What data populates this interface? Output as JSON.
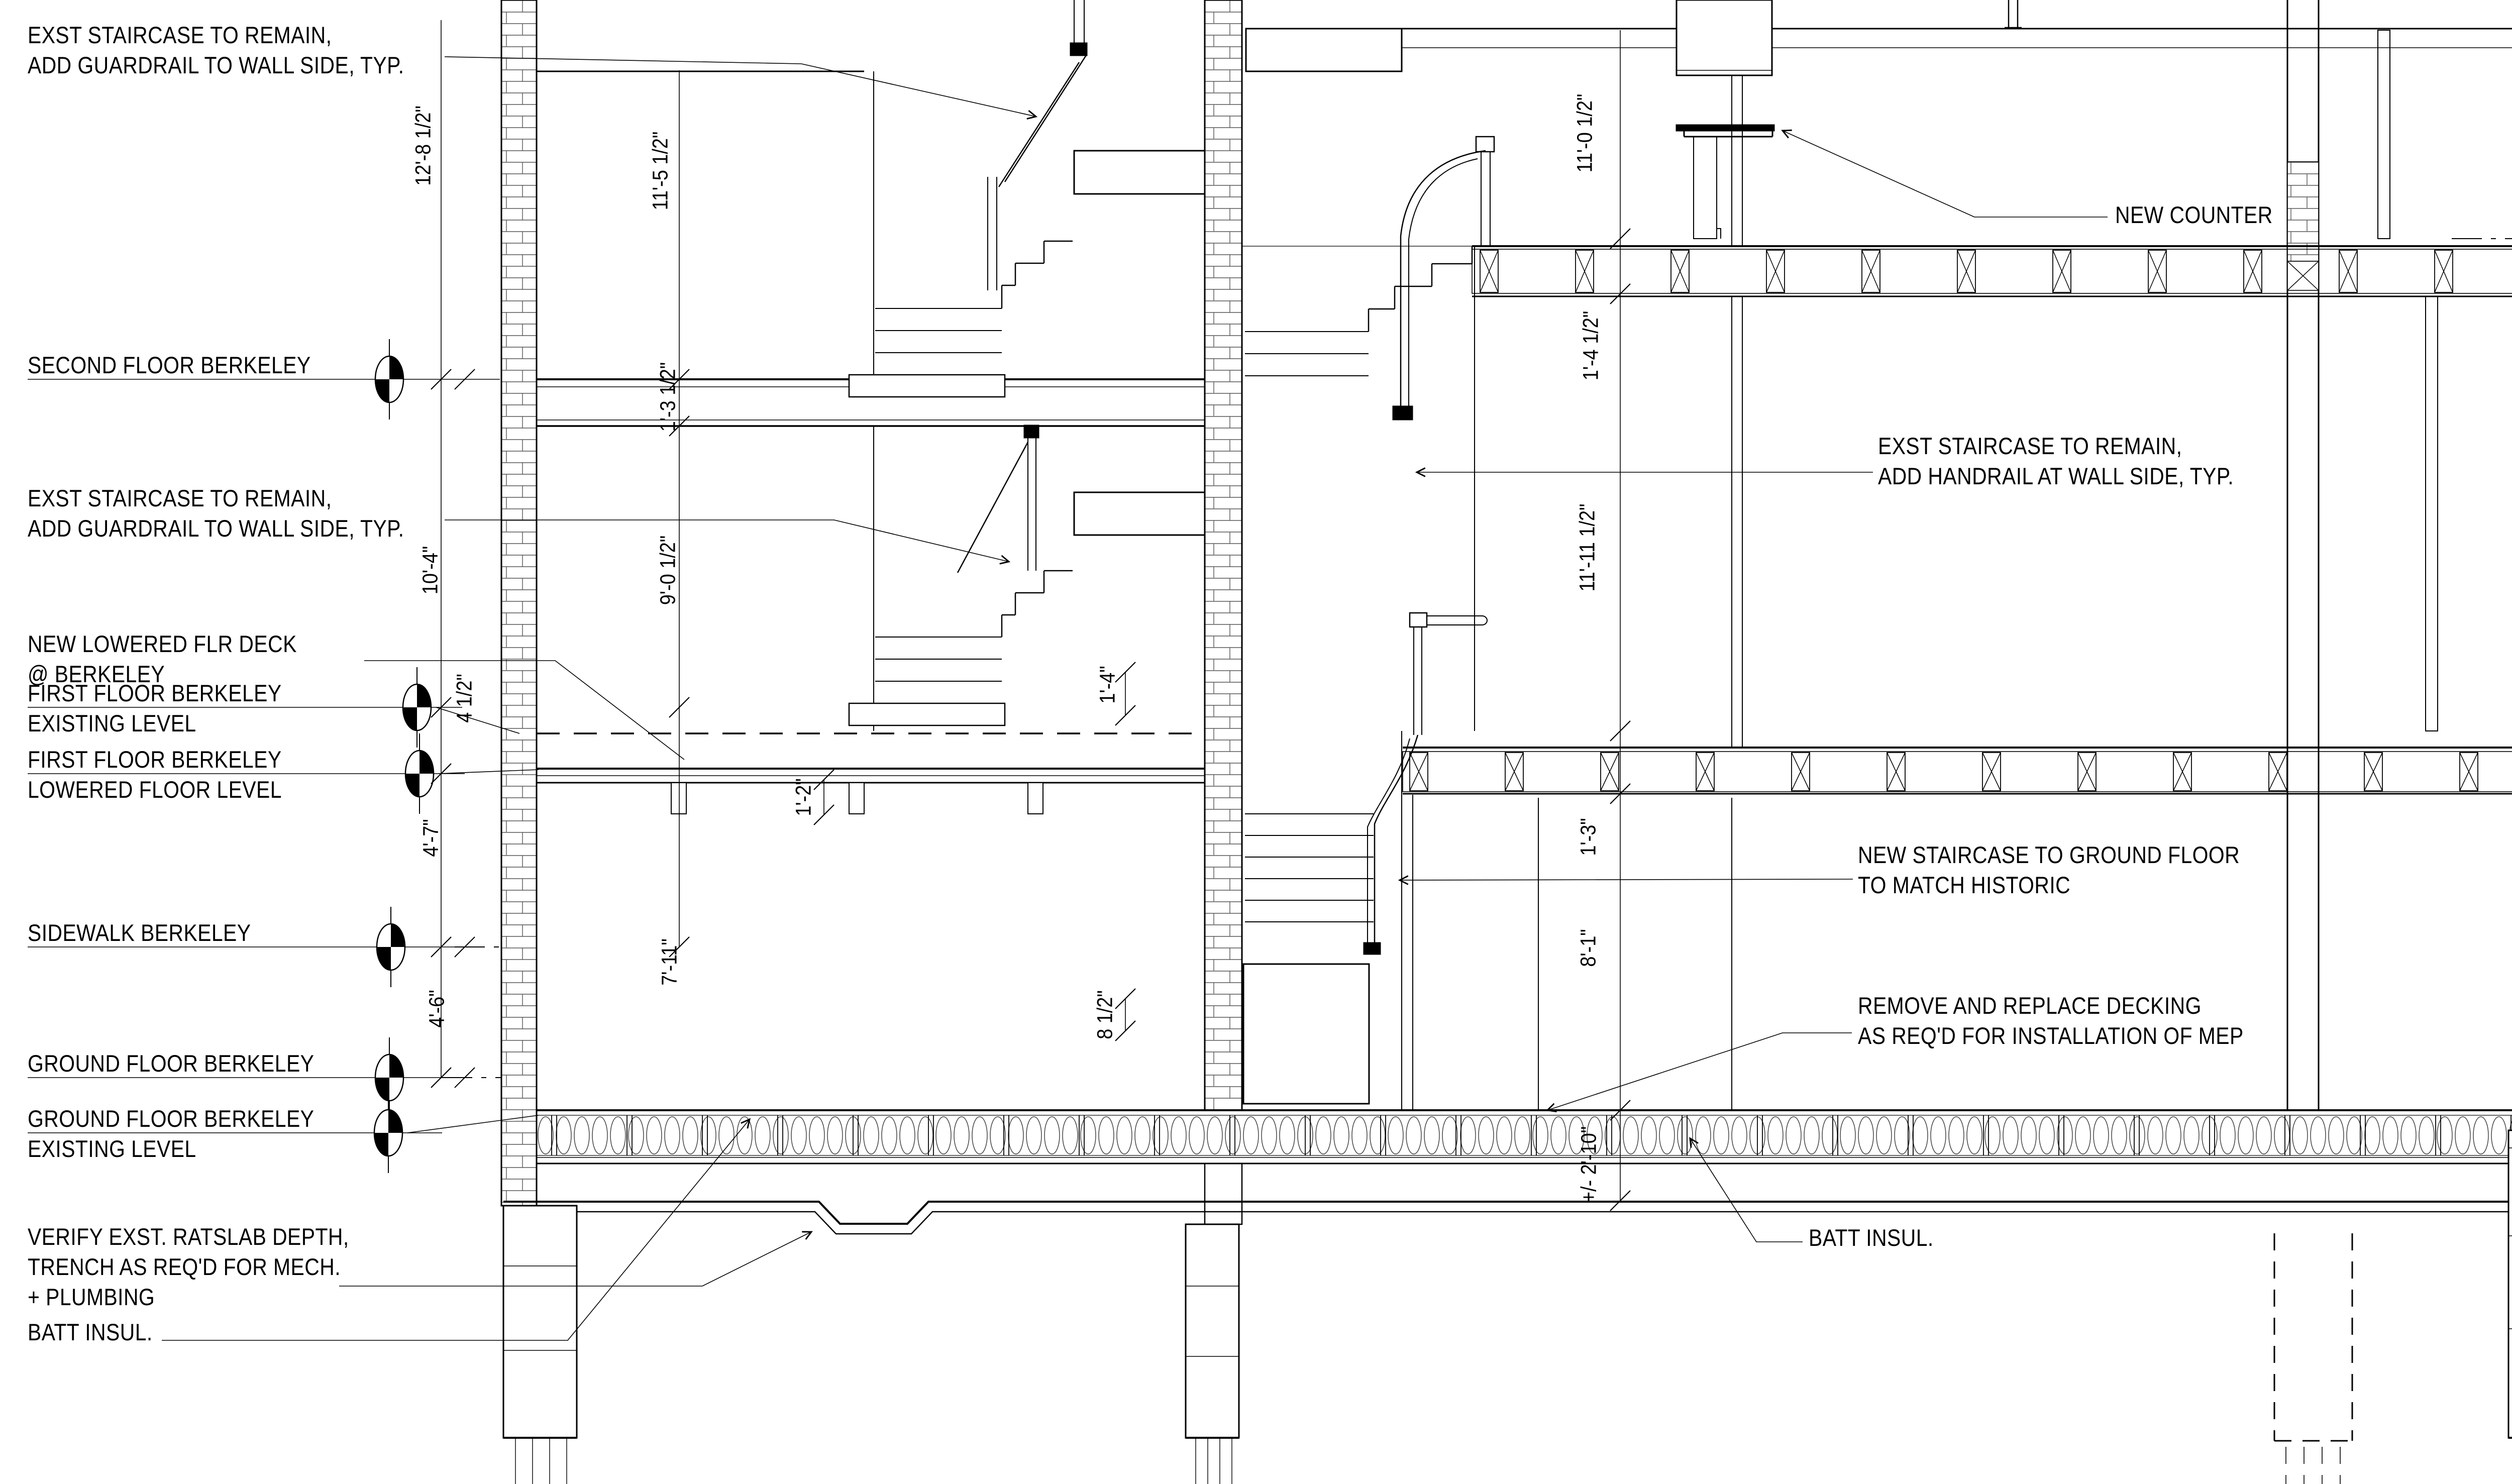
{
  "meta": {
    "drawing_type": "building section"
  },
  "colors": {
    "ink": "#000000",
    "paper": "#ffffff"
  },
  "callouts": {
    "exst_guardrail_upper": {
      "text": "EXST STAIRCASE TO REMAIN,\nADD GUARDRAIL TO WALL SIDE, TYP."
    },
    "exst_guardrail_lower": {
      "text": "EXST STAIRCASE TO REMAIN,\nADD GUARDRAIL TO WALL SIDE, TYP."
    },
    "new_lowered_deck": {
      "text": "NEW LOWERED FLR DECK\n@ BERKELEY"
    },
    "verify_ratslab": {
      "text": "VERIFY EXST. RATSLAB DEPTH,\nTRENCH AS REQ'D FOR MECH.\n+ PLUMBING"
    },
    "batt_insul_left": {
      "text": "BATT INSUL."
    },
    "new_counter": {
      "text": "NEW COUNTER"
    },
    "exst_handrail": {
      "text": "EXST STAIRCASE TO REMAIN,\nADD HANDRAIL AT WALL SIDE, TYP."
    },
    "new_staircase": {
      "text": "NEW STAIRCASE TO GROUND FLOOR\nTO MATCH HISTORIC"
    },
    "remove_decking": {
      "text": "REMOVE AND REPLACE DECKING\nAS REQ'D FOR INSTALLATION OF MEP"
    },
    "batt_insul_center": {
      "text": "BATT INSUL."
    },
    "exst_stair": {
      "text": "EXST. STAIR"
    },
    "frame_insulate": {
      "text": "FRAME, INSULATE +\nPLASTER WALLS +\nCLG."
    },
    "new_mtl_handrail": {
      "text": "NEW MTL\nHANDRAIL @\nEXST. STAIR"
    },
    "exst_conc_slab": {
      "text": "EXST CONC SLAB, PTD"
    }
  },
  "levels": {
    "second_floor_berkeley": {
      "label": "SECOND FLOOR BERKELEY"
    },
    "first_floor_berkeley_existing": {
      "label": "FIRST FLOOR BERKELEY\nEXISTING LEVEL"
    },
    "first_floor_berkeley_lowered": {
      "label": "FIRST FLOOR BERKELEY\nLOWERED FLOOR LEVEL"
    },
    "sidewalk_berkeley": {
      "label": "SIDEWALK BERKELEY"
    },
    "ground_floor_berkeley": {
      "label": "GROUND FLOOR BERKELEY"
    },
    "ground_floor_berkeley_existing": {
      "label": "GROUND FLOOR BERKELEY\nEXISTING LEVEL"
    },
    "second_floor_marlborough": {
      "label": "SECOND FLOOR MARLBOROUGH"
    },
    "first_floor_marlborough": {
      "label": "FIRST FLOOR MARLBOROUGH"
    },
    "sidewalk_marlborough": {
      "label": "SIDEWALK MARLBOROUGH"
    },
    "ground_floor_marlborough": {
      "label": "GROUND FLOOR MARLBOROUGH"
    },
    "crawl_space_slab_marlborough": {
      "label": "CRAWL SPACE SLAB MARLBOROUGH"
    }
  },
  "dims": {
    "d_12_8_half": {
      "text": "12'-8 1/2\""
    },
    "d_11_5_half": {
      "text": "11'-5 1/2\""
    },
    "d_1_3_half": {
      "text": "1'-3 1/2\""
    },
    "d_10_4": {
      "text": "10'-4\""
    },
    "d_9_0_half": {
      "text": "9'-0 1/2\""
    },
    "d_1_4": {
      "text": "1'-4\""
    },
    "d_4_half": {
      "text": "4 1/2\""
    },
    "d_1_2": {
      "text": "1'-2\""
    },
    "d_4_7": {
      "text": "4'-7\""
    },
    "d_7_11": {
      "text": "7'-11\""
    },
    "d_4_6": {
      "text": "4'-6\""
    },
    "d_8_half": {
      "text": "8 1/2\""
    },
    "d_11_0_half": {
      "text": "11'-0 1/2\""
    },
    "d_1_4_half": {
      "text": "1'-4 1/2\""
    },
    "d_11_11_half": {
      "text": "11'-11 1/2\""
    },
    "d_1_3": {
      "text": "1'-3\""
    },
    "d_8_1": {
      "text": "8'-1\""
    },
    "d_2_10": {
      "text": "+/- 2'-10\""
    },
    "d_13_4": {
      "text": "13'-4\""
    },
    "d_9_4": {
      "text": "9'-4\""
    },
    "d_12_5": {
      "text": "12'-5\""
    }
  }
}
